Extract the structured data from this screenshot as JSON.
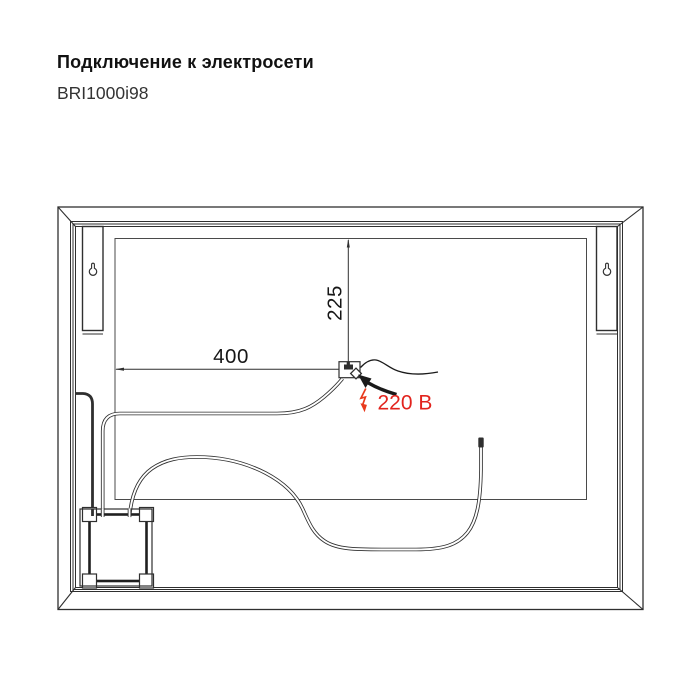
{
  "header": {
    "title": "Подключение к электросети",
    "model": "BRI1000i98"
  },
  "diagram": {
    "dimension_vertical": "225",
    "dimension_horizontal": "400",
    "voltage_label": "220 В",
    "colors": {
      "line": "#2f2f2f",
      "panel_line": "#4a4a4a",
      "red_text": "#e2231d",
      "red_bolt": "#e8391c"
    }
  }
}
